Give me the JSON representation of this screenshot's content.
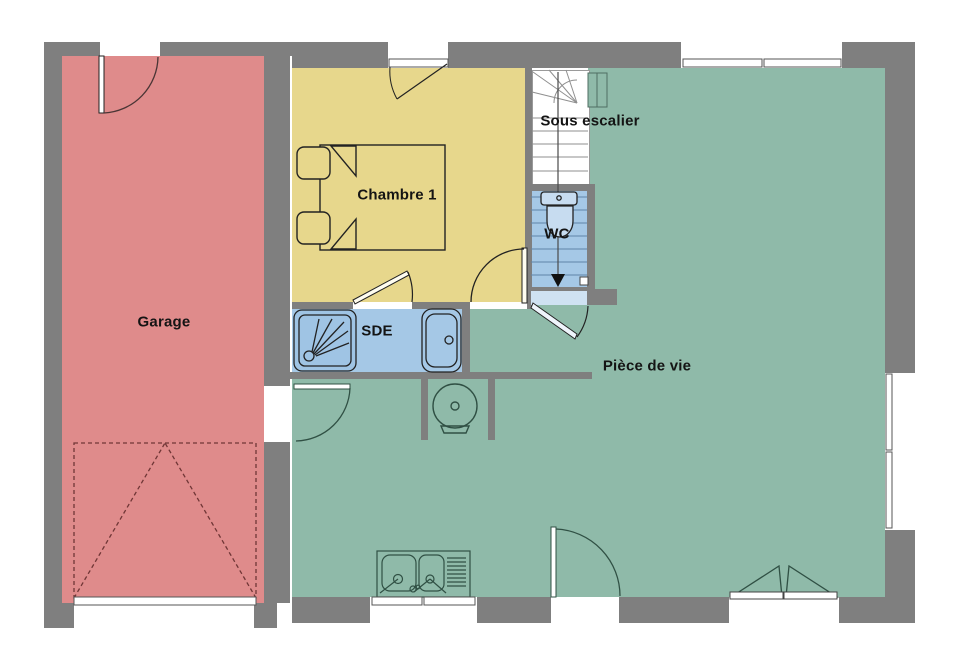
{
  "title": "Plan de rez-de-chaussée",
  "rooms": {
    "garage": {
      "label": "Garage",
      "color": "#df8b8b"
    },
    "chambre1": {
      "label": "Chambre 1",
      "color": "#e7d78c"
    },
    "sous_escalier": {
      "label": "Sous escalier",
      "color": "#ffffff"
    },
    "wc": {
      "label": "WC",
      "color": "#a5c8e6"
    },
    "sde": {
      "label": "SDE",
      "color": "#a5c8e6"
    },
    "piece_de_vie": {
      "label": "Pièce de vie",
      "color": "#8fbaa9"
    }
  },
  "colors": {
    "wall": "#7f7f7f",
    "background": "#ffffff",
    "threshold": "#cfe2f2",
    "outline": "#262626",
    "green_outline": "#305044",
    "stair_tread": "#8f8f8f",
    "wc_tread": "#5f85a8",
    "garage_door_dash": "#703636"
  }
}
